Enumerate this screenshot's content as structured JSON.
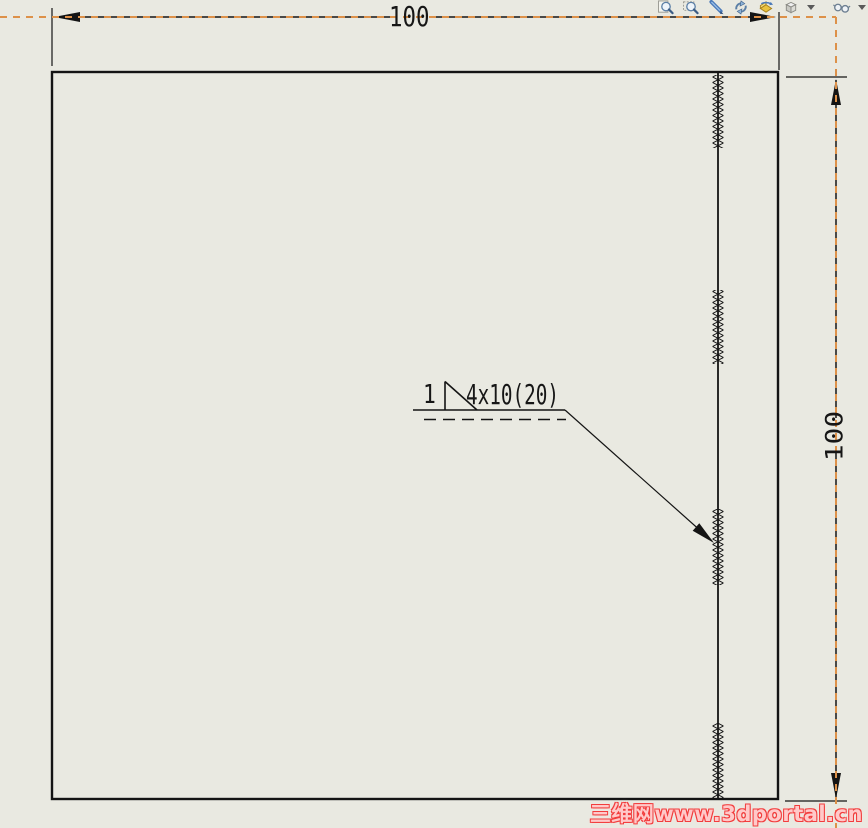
{
  "colors": {
    "background": "#e9e9e1",
    "line": "#141414",
    "sheet_boundary": "#dd9149",
    "watermark_red": "#f23c3c"
  },
  "toolbar": {
    "icons": [
      {
        "name": "zoom-to-fit"
      },
      {
        "name": "zoom-to-area"
      },
      {
        "name": "zoom-in-out"
      },
      {
        "name": "rotate-view"
      },
      {
        "name": "3d-drawing-view"
      },
      {
        "name": "view-orientation",
        "has_dropdown": true
      },
      {
        "name": "hide-show-items",
        "has_dropdown": true
      }
    ]
  },
  "drawing": {
    "dimensions": {
      "top": "100",
      "right": "100"
    },
    "weld_annotation": {
      "reference_number": "1",
      "spec": "4x10(20)"
    }
  },
  "watermark": "三维网www.3dportal.cn"
}
